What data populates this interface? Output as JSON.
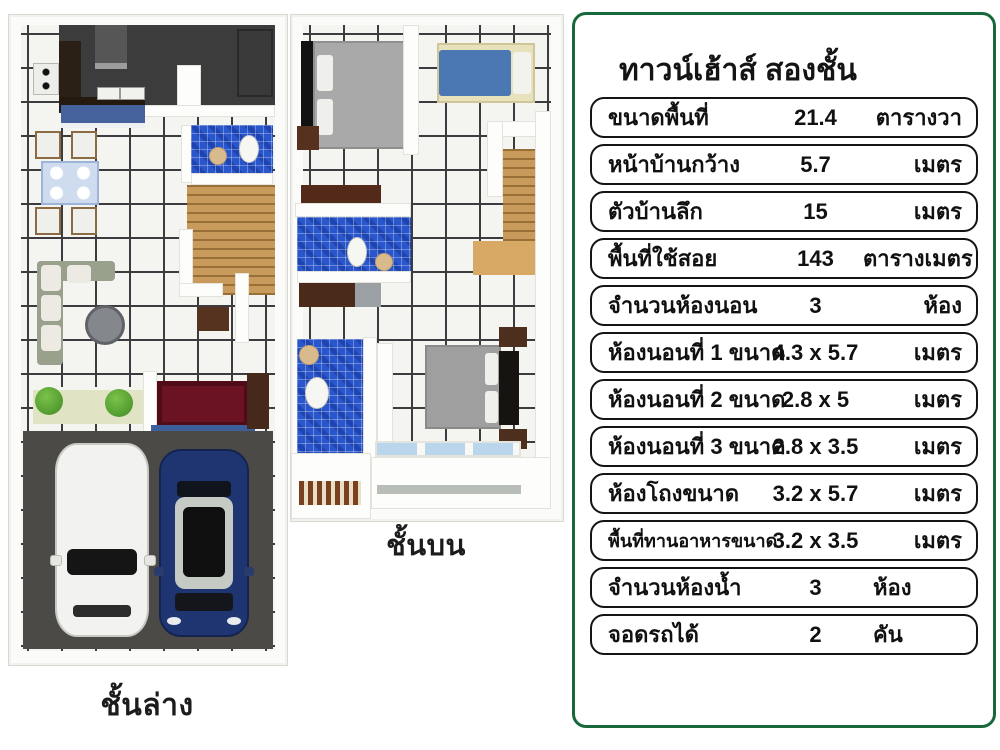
{
  "floor_plans": {
    "ground": {
      "caption": "ชั้นล่าง"
    },
    "upper": {
      "caption": "ชั้นบน"
    }
  },
  "spec_panel": {
    "title": "ทาวน์เฮ้าส์ สองชั้น",
    "border_color": "#17693c",
    "rows": [
      {
        "label": "ขนาดพื้นที่",
        "value": "21.4",
        "unit": "ตารางวา"
      },
      {
        "label": "หน้าบ้านกว้าง",
        "value": "5.7",
        "unit": "เมตร"
      },
      {
        "label": "ตัวบ้านลึก",
        "value": "15",
        "unit": "เมตร"
      },
      {
        "label": "พื้นที่ใช้สอย",
        "value": "143",
        "unit": "ตารางเมตร"
      },
      {
        "label": "จำนวนห้องนอน",
        "value": "3",
        "unit": "ห้อง"
      },
      {
        "label": "ห้องนอนที่ 1 ขนาด",
        "value": "4.3 x 5.7",
        "unit": "เมตร"
      },
      {
        "label": "ห้องนอนที่ 2 ขนาด",
        "value": "2.8 x 5",
        "unit": "เมตร"
      },
      {
        "label": "ห้องนอนที่ 3 ขนาด",
        "value": "2.8 x 3.5",
        "unit": "เมตร"
      },
      {
        "label": "ห้องโถงขนาด",
        "value": "3.2 x 5.7",
        "unit": "เมตร"
      },
      {
        "label": "พื้นที่ทานอาหารขนาด",
        "value": "3.2 x 3.5",
        "unit": "เมตร"
      },
      {
        "label": "จำนวนห้องน้ำ",
        "value": "3",
        "unit": "ห้อง"
      },
      {
        "label": "จอดรถได้",
        "value": "2",
        "unit": "คัน"
      }
    ]
  },
  "colors": {
    "panel_border_green": "#17693c",
    "mosaic_blue": "#2a56cc",
    "stair_wood": "#c89a5c",
    "garage_gray": "#4b4a47",
    "car_white": "#f2f2f0",
    "car_blue": "#1e3572"
  }
}
